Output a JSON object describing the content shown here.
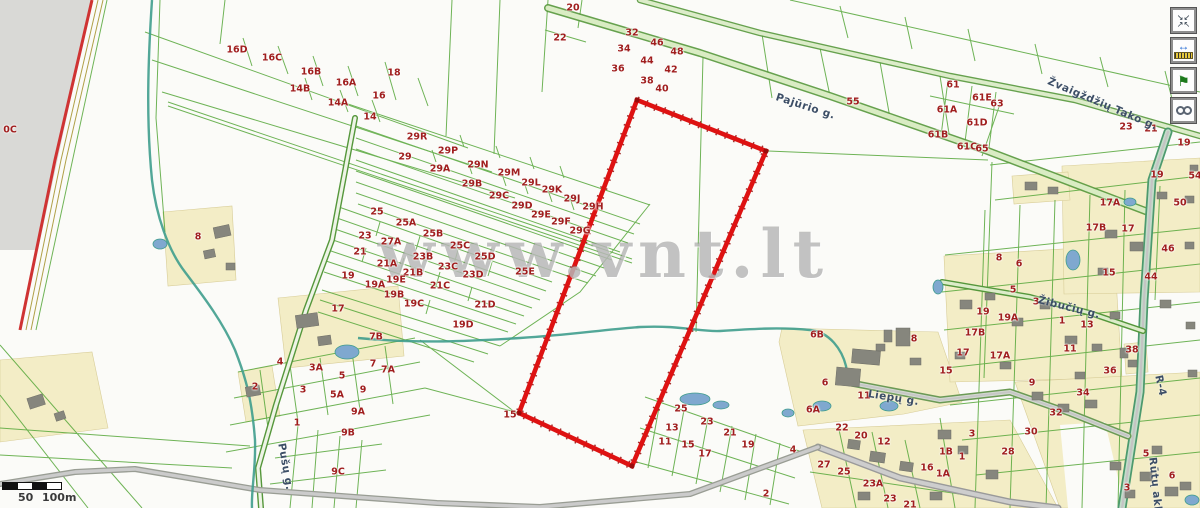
{
  "map": {
    "watermark": "www.vnt.lt"
  },
  "scale_bar": {
    "mid_label": "50",
    "end_label": "100m"
  },
  "toolbar": {
    "buttons": [
      {
        "name": "zoom-extent-button",
        "icon": "arrows-inward-icon",
        "title": "Zoom to extent"
      },
      {
        "name": "measure-button",
        "icon": "measure-icon",
        "title": "Measure"
      },
      {
        "name": "flag-button",
        "icon": "flag-icon",
        "title": "Mark location"
      },
      {
        "name": "link-button",
        "icon": "link-icon",
        "title": "Link"
      }
    ]
  },
  "colors": {
    "parcel_number": "#a01e1e",
    "street_name": "#3c4e66",
    "parcel_line": "#56a73a",
    "selected_outline": "#de1212",
    "water": "#3f9d8d",
    "built_area": "#f3edc6",
    "out_of_coverage": "#d9d9d6"
  },
  "street_labels": [
    {
      "t": "Pajūrio g.",
      "x": 776,
      "y": 92,
      "rot": 18
    },
    {
      "t": "Žvaigždžių Tako g.",
      "x": 1048,
      "y": 76,
      "rot": 23
    },
    {
      "t": "Žibučių g.",
      "x": 1038,
      "y": 295,
      "rot": 14
    },
    {
      "t": "Liepų g.",
      "x": 868,
      "y": 389,
      "rot": 9
    },
    {
      "t": "Pušų g.",
      "x": 281,
      "y": 438,
      "rot": 80
    },
    {
      "t": "Rūtų aklg.",
      "x": 1152,
      "y": 452,
      "rot": 84
    },
    {
      "t": "R-4",
      "x": 1158,
      "y": 370,
      "rot": 78
    }
  ],
  "parcel_labels": [
    {
      "t": "0C",
      "x": 10,
      "y": 130
    },
    {
      "t": "20",
      "x": 573,
      "y": 8
    },
    {
      "t": "22",
      "x": 560,
      "y": 38
    },
    {
      "t": "32",
      "x": 632,
      "y": 33
    },
    {
      "t": "34",
      "x": 624,
      "y": 49
    },
    {
      "t": "46",
      "x": 657,
      "y": 43
    },
    {
      "t": "48",
      "x": 677,
      "y": 52
    },
    {
      "t": "36",
      "x": 618,
      "y": 69
    },
    {
      "t": "44",
      "x": 647,
      "y": 61
    },
    {
      "t": "42",
      "x": 671,
      "y": 70
    },
    {
      "t": "38",
      "x": 647,
      "y": 81
    },
    {
      "t": "40",
      "x": 662,
      "y": 89
    },
    {
      "t": "16D",
      "x": 237,
      "y": 50
    },
    {
      "t": "16C",
      "x": 272,
      "y": 58
    },
    {
      "t": "16B",
      "x": 311,
      "y": 72
    },
    {
      "t": "16A",
      "x": 346,
      "y": 83
    },
    {
      "t": "18",
      "x": 394,
      "y": 73
    },
    {
      "t": "14B",
      "x": 300,
      "y": 89
    },
    {
      "t": "16",
      "x": 379,
      "y": 96
    },
    {
      "t": "14A",
      "x": 338,
      "y": 103
    },
    {
      "t": "14",
      "x": 370,
      "y": 117
    },
    {
      "t": "29R",
      "x": 417,
      "y": 137
    },
    {
      "t": "29",
      "x": 405,
      "y": 157
    },
    {
      "t": "29P",
      "x": 448,
      "y": 151
    },
    {
      "t": "29A",
      "x": 440,
      "y": 169
    },
    {
      "t": "29N",
      "x": 478,
      "y": 165
    },
    {
      "t": "29M",
      "x": 509,
      "y": 173
    },
    {
      "t": "29B",
      "x": 472,
      "y": 184
    },
    {
      "t": "29L",
      "x": 531,
      "y": 183
    },
    {
      "t": "29K",
      "x": 552,
      "y": 190
    },
    {
      "t": "29C",
      "x": 499,
      "y": 196
    },
    {
      "t": "29J",
      "x": 572,
      "y": 199
    },
    {
      "t": "29D",
      "x": 522,
      "y": 206
    },
    {
      "t": "29H",
      "x": 593,
      "y": 207
    },
    {
      "t": "29E",
      "x": 541,
      "y": 215
    },
    {
      "t": "29F",
      "x": 561,
      "y": 222
    },
    {
      "t": "29G",
      "x": 580,
      "y": 231
    },
    {
      "t": "25",
      "x": 377,
      "y": 212
    },
    {
      "t": "25A",
      "x": 406,
      "y": 223
    },
    {
      "t": "23",
      "x": 365,
      "y": 236
    },
    {
      "t": "25B",
      "x": 433,
      "y": 234
    },
    {
      "t": "27A",
      "x": 391,
      "y": 242
    },
    {
      "t": "25C",
      "x": 460,
      "y": 246
    },
    {
      "t": "21",
      "x": 360,
      "y": 252
    },
    {
      "t": "23B",
      "x": 423,
      "y": 257
    },
    {
      "t": "25D",
      "x": 485,
      "y": 257
    },
    {
      "t": "21A",
      "x": 387,
      "y": 264
    },
    {
      "t": "23C",
      "x": 448,
      "y": 267
    },
    {
      "t": "21B",
      "x": 413,
      "y": 273
    },
    {
      "t": "23D",
      "x": 473,
      "y": 275
    },
    {
      "t": "25E",
      "x": 525,
      "y": 272
    },
    {
      "t": "19",
      "x": 348,
      "y": 276
    },
    {
      "t": "19A",
      "x": 375,
      "y": 285
    },
    {
      "t": "19E",
      "x": 396,
      "y": 280
    },
    {
      "t": "21C",
      "x": 440,
      "y": 286
    },
    {
      "t": "19B",
      "x": 394,
      "y": 295
    },
    {
      "t": "19C",
      "x": 414,
      "y": 304
    },
    {
      "t": "21D",
      "x": 485,
      "y": 305
    },
    {
      "t": "19D",
      "x": 463,
      "y": 325
    },
    {
      "t": "8",
      "x": 198,
      "y": 237
    },
    {
      "t": "17",
      "x": 338,
      "y": 309
    },
    {
      "t": "7B",
      "x": 376,
      "y": 337
    },
    {
      "t": "4",
      "x": 280,
      "y": 362
    },
    {
      "t": "3A",
      "x": 316,
      "y": 368
    },
    {
      "t": "7",
      "x": 373,
      "y": 364
    },
    {
      "t": "7A",
      "x": 388,
      "y": 370
    },
    {
      "t": "5",
      "x": 342,
      "y": 376
    },
    {
      "t": "2",
      "x": 255,
      "y": 387
    },
    {
      "t": "3",
      "x": 303,
      "y": 390
    },
    {
      "t": "5A",
      "x": 337,
      "y": 395
    },
    {
      "t": "9",
      "x": 363,
      "y": 390
    },
    {
      "t": "9A",
      "x": 358,
      "y": 412
    },
    {
      "t": "1",
      "x": 297,
      "y": 423
    },
    {
      "t": "9B",
      "x": 348,
      "y": 433
    },
    {
      "t": "9C",
      "x": 338,
      "y": 472
    },
    {
      "t": "15",
      "x": 510,
      "y": 415
    },
    {
      "t": "55",
      "x": 853,
      "y": 102
    },
    {
      "t": "61",
      "x": 953,
      "y": 85
    },
    {
      "t": "61E",
      "x": 982,
      "y": 98
    },
    {
      "t": "63",
      "x": 997,
      "y": 104
    },
    {
      "t": "61A",
      "x": 947,
      "y": 110
    },
    {
      "t": "61D",
      "x": 977,
      "y": 123
    },
    {
      "t": "61B",
      "x": 938,
      "y": 135
    },
    {
      "t": "61C",
      "x": 967,
      "y": 147
    },
    {
      "t": "65",
      "x": 982,
      "y": 149
    },
    {
      "t": "23",
      "x": 1126,
      "y": 127
    },
    {
      "t": "21",
      "x": 1151,
      "y": 129
    },
    {
      "t": "19",
      "x": 1184,
      "y": 143
    },
    {
      "t": "54",
      "x": 1195,
      "y": 176
    },
    {
      "t": "19",
      "x": 1157,
      "y": 175
    },
    {
      "t": "50",
      "x": 1180,
      "y": 203
    },
    {
      "t": "17A",
      "x": 1110,
      "y": 203
    },
    {
      "t": "17B",
      "x": 1096,
      "y": 228
    },
    {
      "t": "17",
      "x": 1128,
      "y": 229
    },
    {
      "t": "46",
      "x": 1168,
      "y": 249
    },
    {
      "t": "15",
      "x": 1109,
      "y": 273
    },
    {
      "t": "44",
      "x": 1151,
      "y": 277
    },
    {
      "t": "38",
      "x": 1132,
      "y": 350
    },
    {
      "t": "8",
      "x": 999,
      "y": 258
    },
    {
      "t": "6",
      "x": 1019,
      "y": 264
    },
    {
      "t": "5",
      "x": 1013,
      "y": 290
    },
    {
      "t": "3",
      "x": 1036,
      "y": 302
    },
    {
      "t": "19",
      "x": 983,
      "y": 312
    },
    {
      "t": "19A",
      "x": 1008,
      "y": 318
    },
    {
      "t": "1",
      "x": 1062,
      "y": 321
    },
    {
      "t": "13",
      "x": 1087,
      "y": 325
    },
    {
      "t": "17B",
      "x": 975,
      "y": 333
    },
    {
      "t": "11",
      "x": 1070,
      "y": 349
    },
    {
      "t": "17",
      "x": 963,
      "y": 353
    },
    {
      "t": "17A",
      "x": 1000,
      "y": 356
    },
    {
      "t": "15",
      "x": 946,
      "y": 371
    },
    {
      "t": "36",
      "x": 1110,
      "y": 371
    },
    {
      "t": "6B",
      "x": 817,
      "y": 335
    },
    {
      "t": "8",
      "x": 914,
      "y": 339
    },
    {
      "t": "6",
      "x": 825,
      "y": 383
    },
    {
      "t": "11",
      "x": 864,
      "y": 396
    },
    {
      "t": "6A",
      "x": 813,
      "y": 410
    },
    {
      "t": "22",
      "x": 842,
      "y": 428
    },
    {
      "t": "20",
      "x": 861,
      "y": 436
    },
    {
      "t": "12",
      "x": 884,
      "y": 442
    },
    {
      "t": "3",
      "x": 972,
      "y": 434
    },
    {
      "t": "1B",
      "x": 946,
      "y": 452
    },
    {
      "t": "1",
      "x": 962,
      "y": 457
    },
    {
      "t": "28",
      "x": 1008,
      "y": 452
    },
    {
      "t": "27",
      "x": 824,
      "y": 465
    },
    {
      "t": "25",
      "x": 844,
      "y": 472
    },
    {
      "t": "16",
      "x": 927,
      "y": 468
    },
    {
      "t": "1A",
      "x": 943,
      "y": 474
    },
    {
      "t": "23A",
      "x": 873,
      "y": 484
    },
    {
      "t": "23",
      "x": 890,
      "y": 499
    },
    {
      "t": "21",
      "x": 910,
      "y": 505
    },
    {
      "t": "25",
      "x": 681,
      "y": 409
    },
    {
      "t": "23",
      "x": 707,
      "y": 422
    },
    {
      "t": "13",
      "x": 672,
      "y": 428
    },
    {
      "t": "21",
      "x": 730,
      "y": 433
    },
    {
      "t": "11",
      "x": 665,
      "y": 442
    },
    {
      "t": "15",
      "x": 688,
      "y": 445
    },
    {
      "t": "19",
      "x": 748,
      "y": 445
    },
    {
      "t": "17",
      "x": 705,
      "y": 454
    },
    {
      "t": "4",
      "x": 793,
      "y": 450
    },
    {
      "t": "2",
      "x": 766,
      "y": 494
    },
    {
      "t": "9",
      "x": 1032,
      "y": 383
    },
    {
      "t": "34",
      "x": 1083,
      "y": 393
    },
    {
      "t": "32",
      "x": 1056,
      "y": 413
    },
    {
      "t": "30",
      "x": 1031,
      "y": 432
    },
    {
      "t": "5",
      "x": 1146,
      "y": 454
    },
    {
      "t": "6",
      "x": 1172,
      "y": 476
    },
    {
      "t": "3",
      "x": 1127,
      "y": 488
    }
  ]
}
